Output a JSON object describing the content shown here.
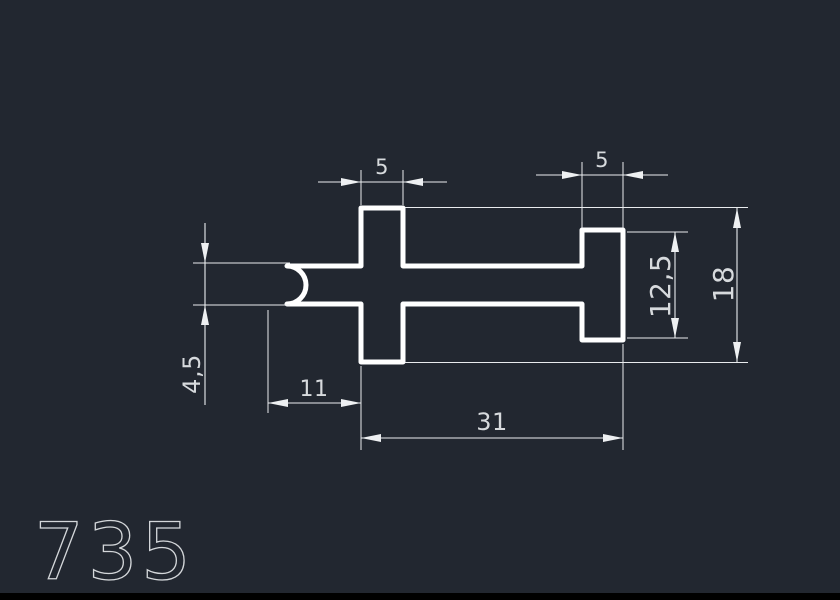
{
  "window": {
    "description": "CAD technical drawing viewport, dark background, white profile cross-section"
  },
  "colors": {
    "background": "#222730",
    "profile_line": "#ffffff",
    "dimension_line": "#eceef0",
    "text": "#d7dadd",
    "bottom_edge": "#000000"
  },
  "drawing": {
    "part_number": "735",
    "units": "mm",
    "dim_labels": {
      "cross_width": "5",
      "flange_width": "5",
      "flange_height": "12,5",
      "overall_height": "18",
      "bar_thickness": "4,5",
      "left_overhang": "11",
      "main_length": "31"
    }
  }
}
